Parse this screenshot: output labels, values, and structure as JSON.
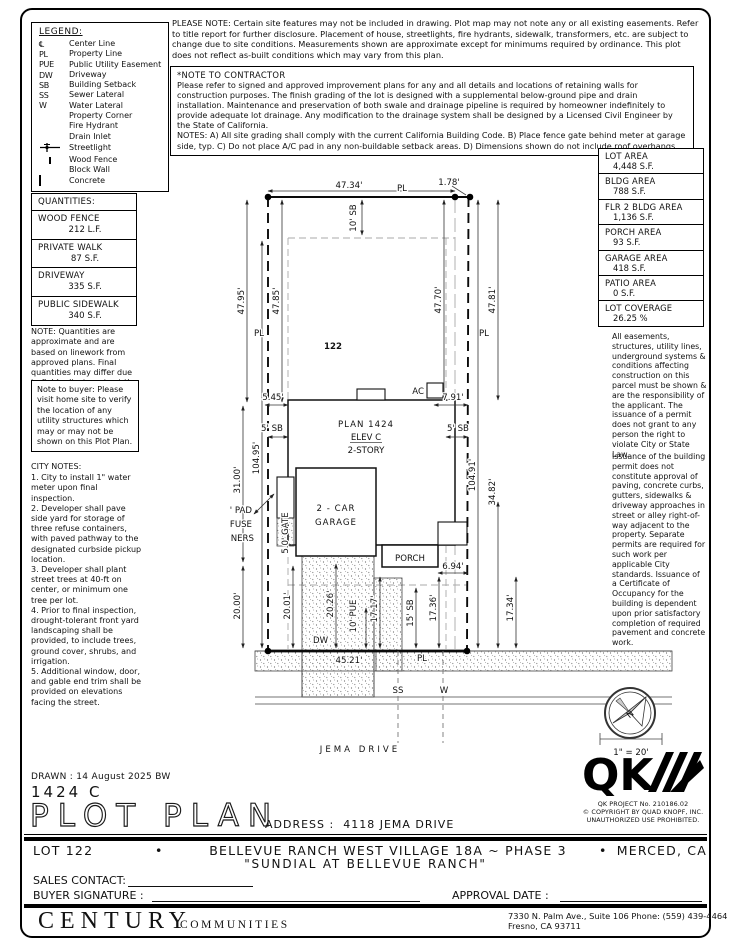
{
  "legend": {
    "title": "LEGEND:",
    "items": [
      {
        "sym": "℄",
        "label": "Center Line"
      },
      {
        "sym": "PL",
        "label": "Property Line"
      },
      {
        "sym": "PUE",
        "label": "Public Utility Easement"
      },
      {
        "sym": "DW",
        "label": "Driveway"
      },
      {
        "sym": "SB",
        "label": "Building Setback"
      },
      {
        "sym": "SS",
        "label": "Sewer Lateral"
      },
      {
        "sym": "W",
        "label": "Water Lateral"
      },
      {
        "icon": "property-corner-icon",
        "label": "Property Corner"
      },
      {
        "icon": "fire-hydrant-icon",
        "label": "Fire Hydrant"
      },
      {
        "icon": "drain-inlet-icon",
        "label": "Drain Inlet"
      },
      {
        "icon": "streetlight-icon",
        "label": "Streetlight"
      },
      {
        "icon": "wood-fence-icon",
        "label": "Wood Fence"
      },
      {
        "icon": "block-wall-icon",
        "label": "Block Wall"
      },
      {
        "icon": "concrete-icon",
        "label": "Concrete"
      }
    ]
  },
  "please_note": "PLEASE NOTE:  Certain site features may not be included in drawing. Plot map may not note any or all existing easements. Refer to title report for further disclosure. Placement of house, streetlights, fire hydrants, sidewalk, transformers, etc. are subject to change due to site conditions. Measurements shown are approximate except for minimums required by ordinance. This plot does not reflect as-built conditions which may vary from this plan.",
  "contractor_note": {
    "title": "*NOTE TO CONTRACTOR",
    "body": "Please refer to signed and approved improvement plans for any and all details and locations of retaining walls for construction purposes. The finish grading of the lot is designed with a supplemental below-ground pipe and drain installation. Maintenance and preservation of both swale and drainage pipeline is required by homeowner indefinitely to provide adequate lot drainage. Any modification to the drainage system shall be designed by a Licensed Civil Engineer by the State of California.",
    "notes": "NOTES:  A) All site grading shall comply with the current California Building Code.  B) Place fence gate behind meter at garage side, typ. C) Do not place A/C pad in any non-buildable setback areas.  D) Dimensions shown do not include roof overhangs."
  },
  "quantities": {
    "title": "QUANTITIES:",
    "items": [
      {
        "name": "WOOD FENCE",
        "value": "212 L.F."
      },
      {
        "name": "PRIVATE WALK",
        "value": "87 S.F."
      },
      {
        "name": "DRIVEWAY",
        "value": "335 S.F."
      },
      {
        "name": "PUBLIC SIDEWALK",
        "value": "340 S.F."
      }
    ],
    "note": "NOTE: Quantities are approximate and are based on linework from approved plans.  Final quantities may differ due to field adjustments at the time of construction."
  },
  "buyer_note": "Note to buyer: Please visit home site to verify the location of any utility structures which may or may not be shown on this Plot Plan.",
  "city_notes": {
    "title": "CITY NOTES:",
    "items": [
      "1. City to install 1\" water meter upon final inspection.",
      "2. Developer shall pave side yard for storage of three refuse containers, with paved pathway to the designated curbside pickup location.",
      "3. Developer shall plant street trees at 40-ft on center, or minimum one tree per lot.",
      "4. Prior to final inspection, drought-tolerant front yard landscaping shall be provided, to include trees, ground cover, shrubs, and irrigation.",
      "5. Additional window, door, and gable end trim shall be provided on elevations facing the street."
    ]
  },
  "areas": [
    {
      "name": "LOT AREA",
      "value": "4,448 S.F."
    },
    {
      "name": "BLDG AREA",
      "value": "788 S.F."
    },
    {
      "name": "FLR 2 BLDG AREA",
      "value": "1,136 S.F."
    },
    {
      "name": "PORCH AREA",
      "value": "93 S.F."
    },
    {
      "name": "GARAGE AREA",
      "value": "418 S.F."
    },
    {
      "name": "PATIO AREA",
      "value": "0 S.F."
    },
    {
      "name": "LOT COVERAGE",
      "value": "26.25 %"
    }
  ],
  "right_notes": {
    "p1": "All easements, structures, utility lines, underground systems & conditions affecting construction on this parcel must be shown & are the responsibility of the applicant. The issuance of a permit does not grant to any person the right to violate City or State Law.",
    "p2": "Issuance of the building permit does not constitute approval of paving, concrete curbs, gutters, sidewalks & driveway approaches in street or alley right-of-way adjacent to the property. Separate permits are required for such work per applicable City standards. Issuance of a Certificate of Occupancy for the building is dependent upon prior satisfactory completion of required pavement and concrete work."
  },
  "plot": {
    "lot_number": "122",
    "dims": {
      "top": "47.34'",
      "top_jog": "1.78'",
      "sb_top": "10' SB",
      "left_outer": "47.95'",
      "left_inner": "47.85'",
      "right_inner": "47.70'",
      "right_outer": "47.81'",
      "left_depth": "104.95'",
      "right_depth": "104.91'",
      "left_mid": "31.00'",
      "left_bottom": "20.00'",
      "house_left": "5.45'",
      "house_right": "7.91'",
      "sb_left": "5' SB",
      "sb_right": "5' SB",
      "drive_left": "20.01'",
      "drive_width": "20.26'",
      "pue": "10' PUE",
      "walk": "17.17'",
      "sb_front": "15' SB",
      "porch_front": "17.36'",
      "right_front": "17.34'",
      "rear_right": "34.82'",
      "porch_side": "6.94'",
      "frontage": "45.21'",
      "gate": "5.0' GATE"
    },
    "labels": {
      "pl": "PL",
      "plan": "PLAN 1424",
      "elev": "ELEV C",
      "story": "2-STORY",
      "garage1": "2 - CAR",
      "garage2": "GARAGE",
      "porch": "PORCH",
      "ac": "AC",
      "dw": "DW",
      "pad1": "9'x4' PAD",
      "pad2": "FOR REFUSE",
      "pad3": "CONTAINERS",
      "ss": "SS",
      "w": "W",
      "street": "JEMA DRIVE"
    },
    "compass_n": "N",
    "scale": "1\" = 20'"
  },
  "qk": {
    "logo": "QK",
    "project": "QK PROJECT No. 210186.02",
    "copyright": "© COPYRIGHT BY QUAD KNOPF, INC.",
    "rights": "UNAUTHORIZED USE PROHIBITED."
  },
  "titleblock": {
    "drawn": "DRAWN :  14 August 2025  BW",
    "plan": "1424  C",
    "title": "PLOT PLAN",
    "address_label": "ADDRESS :",
    "address": "4118 JEMA DRIVE"
  },
  "footer": {
    "lot": "LOT 122",
    "bullet": "•",
    "tract": "BELLEVUE RANCH WEST VILLAGE 18A ~ PHASE 3",
    "city": "MERCED, CA",
    "community": "\"SUNDIAL AT BELLEVUE RANCH\"",
    "sales_label": "SALES CONTACT:",
    "signature_label": "BUYER SIGNATURE :",
    "approval_label": "APPROVAL DATE :",
    "brand_a": "CENTURY",
    "brand_b": "COMMUNITIES",
    "addr1": "7330 N. Palm Ave., Suite 106    Phone:  (559) 439-4464",
    "addr2": "Fresno, CA  93711"
  }
}
